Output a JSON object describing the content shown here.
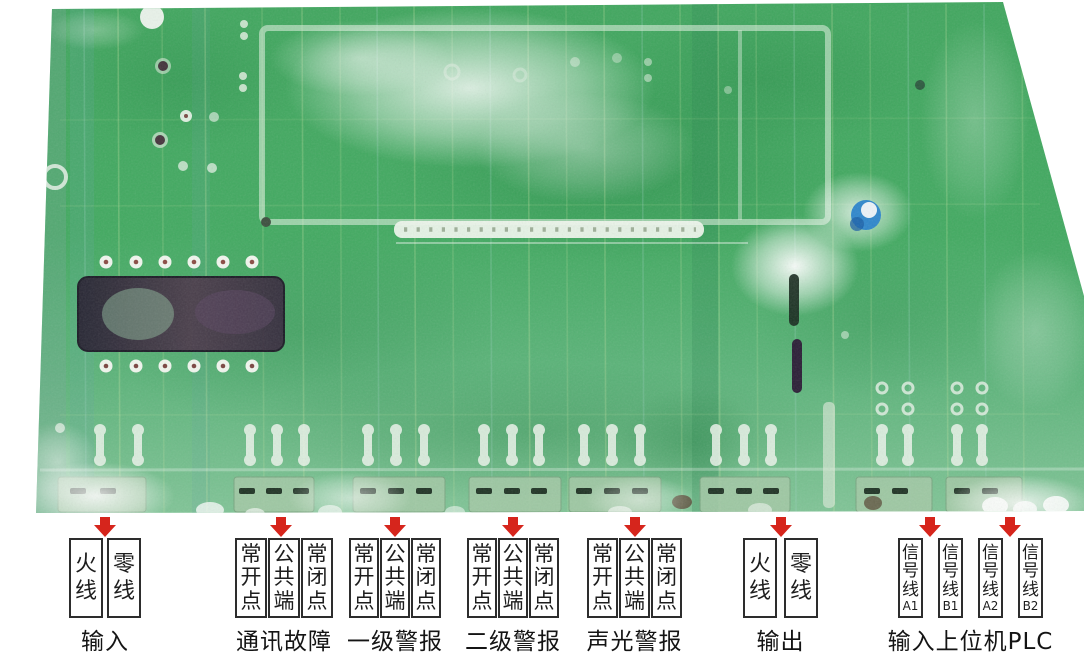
{
  "colors": {
    "arrow_red": "#d6251c",
    "board_green": "#45ab62",
    "box_border": "#2d2d2d",
    "label_text": "#1d1d1d",
    "background": "#ffffff"
  },
  "groups": [
    {
      "id": "input",
      "caption": "输入",
      "boxes": [
        {
          "main": "火线",
          "sub": ""
        },
        {
          "main": "零线",
          "sub": ""
        }
      ]
    },
    {
      "id": "comm-fault",
      "caption": "通讯故障",
      "boxes": [
        {
          "main": "常开点",
          "sub": ""
        },
        {
          "main": "公共端",
          "sub": ""
        },
        {
          "main": "常闭点",
          "sub": ""
        }
      ]
    },
    {
      "id": "alarm-level-1",
      "caption": "一级警报",
      "boxes": [
        {
          "main": "常开点",
          "sub": ""
        },
        {
          "main": "公共端",
          "sub": ""
        },
        {
          "main": "常闭点",
          "sub": ""
        }
      ]
    },
    {
      "id": "alarm-level-2",
      "caption": "二级警报",
      "boxes": [
        {
          "main": "常开点",
          "sub": ""
        },
        {
          "main": "公共端",
          "sub": ""
        },
        {
          "main": "常闭点",
          "sub": ""
        }
      ]
    },
    {
      "id": "sound-light-alarm",
      "caption": "声光警报",
      "boxes": [
        {
          "main": "常开点",
          "sub": ""
        },
        {
          "main": "公共端",
          "sub": ""
        },
        {
          "main": "常闭点",
          "sub": ""
        }
      ]
    },
    {
      "id": "output",
      "caption": "输出",
      "boxes": [
        {
          "main": "火线",
          "sub": ""
        },
        {
          "main": "零线",
          "sub": ""
        }
      ]
    },
    {
      "id": "plc",
      "caption": "输入上位机PLC",
      "boxes": [
        {
          "main": "信号线",
          "sub": "A1"
        },
        {
          "main": "信号线",
          "sub": "B1"
        },
        {
          "main": "信号线",
          "sub": "A2"
        },
        {
          "main": "信号线",
          "sub": "B2"
        }
      ]
    }
  ]
}
